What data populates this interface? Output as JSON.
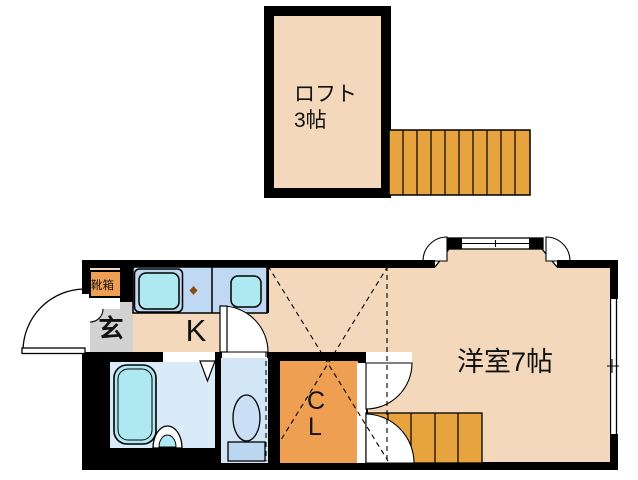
{
  "title": "apartment floor plan with loft",
  "colors": {
    "wall": "#000000",
    "floor_peach": "#F3D8BB",
    "stair_orange": "#E7A33E",
    "closet_orange": "#EE9F52",
    "counter_blue": "#BFD9F2",
    "fixture_cyan": "#AEE9F2",
    "bath_floor": "#D9EAF9",
    "toilet_floor": "#D3E6F6",
    "bowl_blue": "#C8DFF5",
    "tank_blue": "#BCD7F1",
    "genkan_gray": "#D2D2D3",
    "burner_brown": "#8D4A16"
  },
  "loft": {
    "label": "ロフト",
    "size": "3帖"
  },
  "main": {
    "genkan": "玄",
    "kitchen": "K",
    "closet_line1": "C",
    "closet_line2": "L",
    "western_room": "洋室7帖",
    "shoebox": "靴箱"
  }
}
